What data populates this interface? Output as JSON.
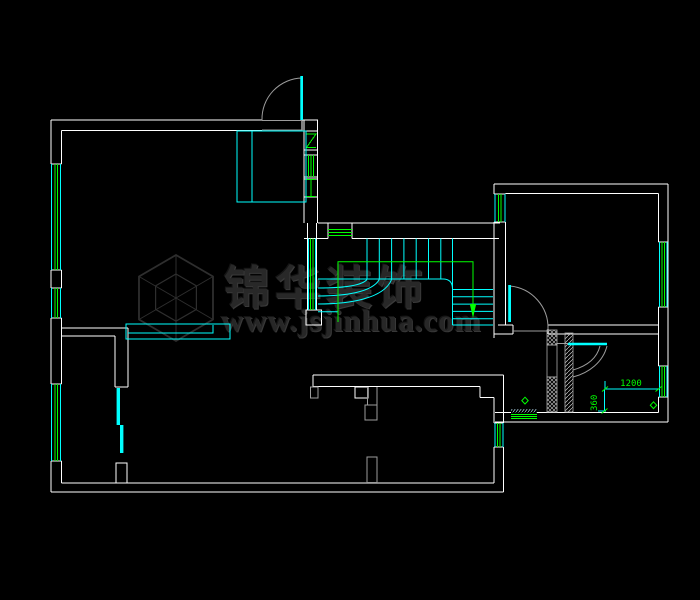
{
  "image_type": "cad-floor-plan-screenshot",
  "watermark": {
    "brand_name": "锦华装饰",
    "website": "www.jsjinhua.com",
    "logo": "isometric-cube-hexagon"
  },
  "annotations": {
    "dim_width": "1200",
    "dim_depth": "360"
  },
  "symbols": {
    "floor_drain_count": 2,
    "direction_arrow": "stair-down-arrow"
  },
  "palette": {
    "background": "#000000",
    "wall_line": "#ffffff",
    "fixture_line": "#00ffff",
    "window_line": "#00ff00",
    "swing_line": "#9c9c9c",
    "hatch_line": "#c9c9c9",
    "watermark_text": "#282828"
  }
}
